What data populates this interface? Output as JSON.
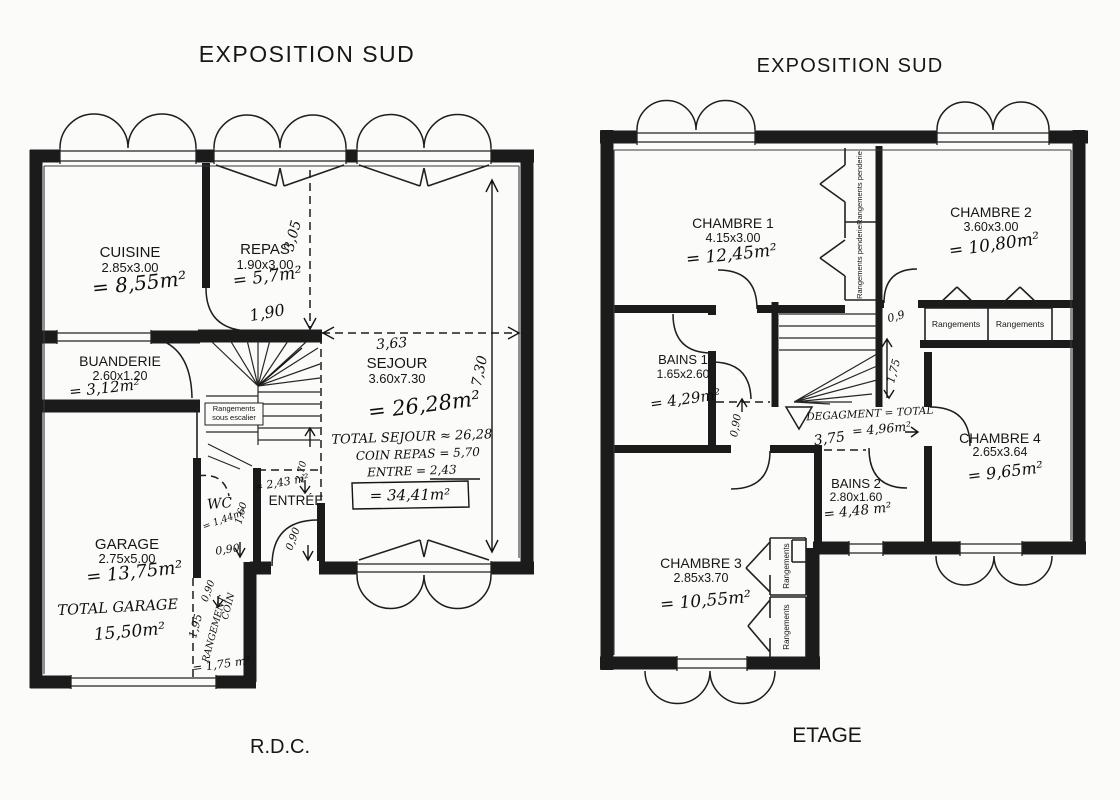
{
  "document": {
    "left_plan_title": "EXPOSITION SUD",
    "right_plan_title": "EXPOSITION SUD",
    "left_plan_caption": "R.D.C.",
    "right_plan_caption": "ETAGE",
    "ink_color": "#1b1b1b",
    "paper_color": "#fbfbf9"
  },
  "rdc": {
    "rooms": [
      {
        "name": "CUISINE",
        "dims": "2.85x3.00",
        "area": "= 8,55m²"
      },
      {
        "name": "REPAS",
        "dims": "1.90x3.00",
        "area": "= 5,7m²"
      },
      {
        "name": "BUANDERIE",
        "dims": "2.60x1.20",
        "area": "= 3,12m²"
      },
      {
        "name": "SEJOUR",
        "dims": "3.60x7.30",
        "area": "= 26,28m²"
      },
      {
        "name": "GARAGE",
        "dims": "2.75x5.00",
        "area": "= 13,75m²"
      },
      {
        "name": "WC",
        "dims": "",
        "area": "= 1,44m²"
      },
      {
        "name": "ENTRÉE",
        "dims": "",
        "area": "= 2,43 m²"
      }
    ],
    "stairs": {
      "label_line1": "Rangements",
      "label_line2": "sous escalier"
    },
    "totals": {
      "sejour_line1": "TOTAL SEJOUR ≈ 26,28",
      "sejour_line2": "COIN REPAS = 5,70",
      "sejour_line3": "ENTRE  = 2,43",
      "sejour_total": "= 34,41m²",
      "garage_label": "TOTAL GARAGE",
      "garage_value": "15,50m²"
    },
    "dims": {
      "repas_depth": "3,05",
      "sejour_width": "3,63",
      "sejour_depth": "7,30",
      "hall_width": "1,90",
      "wc_width": "0,90",
      "wc_depth": "1,60",
      "entree_width": "0,90",
      "entree_depth": "2,70",
      "coin_width": "0,90",
      "coin_label1": "COIN",
      "coin_label2": "RANGEMENT",
      "coin_length": "1,95",
      "coin_area": "= 1,75 m²"
    }
  },
  "etage": {
    "rooms": [
      {
        "name": "CHAMBRE 1",
        "dims": "4.15x3.00",
        "area": "= 12,45m²"
      },
      {
        "name": "CHAMBRE 2",
        "dims": "3.60x3.00",
        "area": "= 10,80m²"
      },
      {
        "name": "BAINS 1",
        "dims": "1.65x2.60",
        "area": "= 4,29m²"
      },
      {
        "name": "CHAMBRE 4",
        "dims": "2.65x3.64",
        "area": "= 9,65m²"
      },
      {
        "name": "BAINS 2",
        "dims": "2.80x1.60",
        "area": "= 4,48 m²"
      },
      {
        "name": "CHAMBRE 3",
        "dims": "2.85x3.70",
        "area": "= 10,55m²"
      }
    ],
    "closets": {
      "penderie_1": "Rangements penderie",
      "penderie_2": "Rangements penderie",
      "ch2_closet_1": "Rangements",
      "ch2_closet_2": "Rangements",
      "ch3_closet_1": "Rangements",
      "ch3_closet_2": "Rangements"
    },
    "degagement": {
      "line1": "DEGAGMENT = TOTAL",
      "line2": "= 4,96m²",
      "length": "3,75"
    },
    "dims": {
      "bains1_door": "0,90",
      "corridor_width": "0,9",
      "corridor_length": "1,75"
    }
  }
}
